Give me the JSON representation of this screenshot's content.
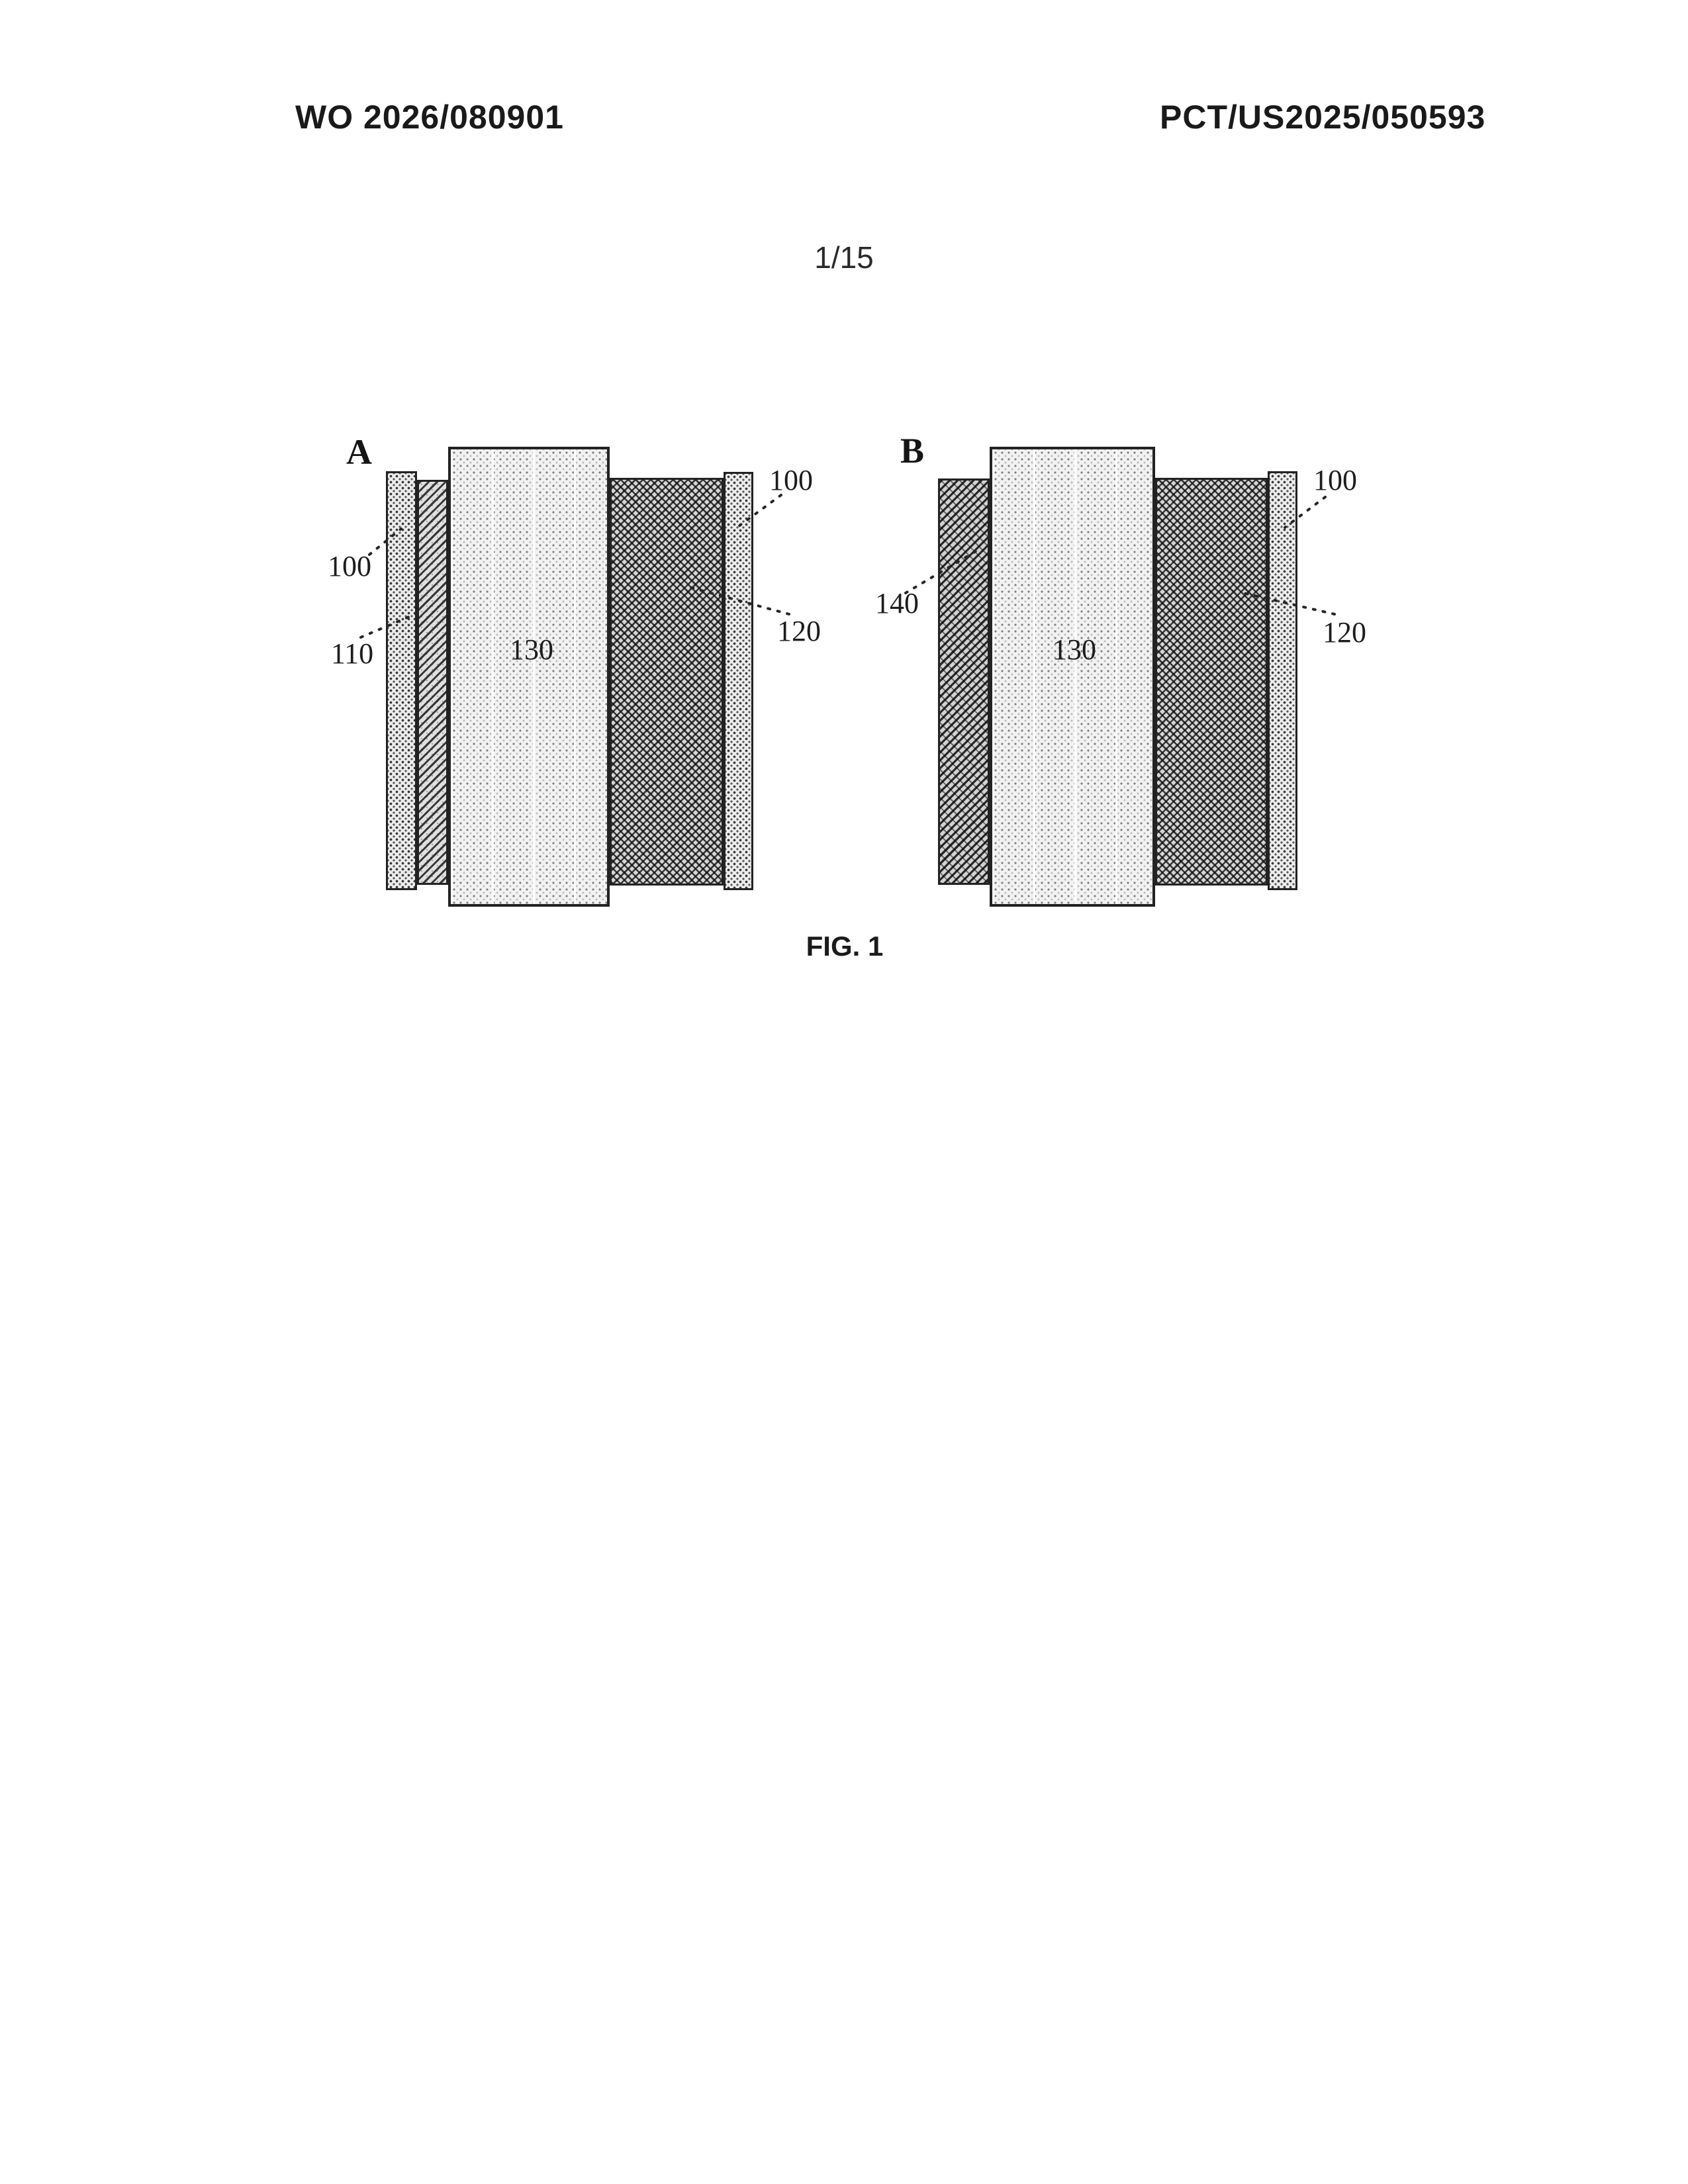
{
  "header": {
    "left": "WO 2026/080901",
    "right": "PCT/US2025/050593"
  },
  "page_number": "1/15",
  "figure": {
    "caption": "FIG. 1",
    "panels": {
      "a": {
        "label": "A",
        "refs": {
          "left_100": "100",
          "left_110": "110",
          "center_130": "130",
          "right_100": "100",
          "right_120": "120"
        }
      },
      "b": {
        "label": "B",
        "refs": {
          "left_140": "140",
          "center_130": "130",
          "right_100": "100",
          "right_120": "120"
        }
      }
    }
  }
}
